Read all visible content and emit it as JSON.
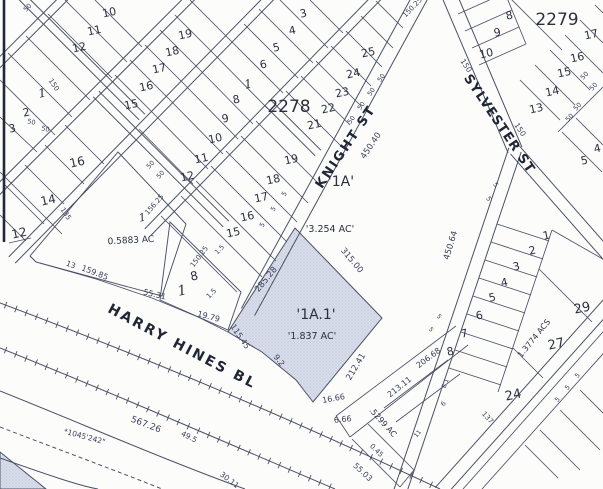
{
  "map": {
    "background": "#fcfcfb",
    "colors": {
      "ink": "#4b5166",
      "text": "#2a3040",
      "dim_text": "#3a415a",
      "street_text": "#1f2636",
      "hatch_fill": "#e3e6f0",
      "hatch_line": "#a9b2cc"
    },
    "block_numbers": [
      {
        "t": "2278",
        "x": 289,
        "y": 112,
        "s": 17
      },
      {
        "t": "2279",
        "x": 557,
        "y": 25,
        "s": 17
      }
    ],
    "street_names": [
      {
        "t": "KNIGHT  ST",
        "x": 349,
        "y": 149,
        "r": -56,
        "s": 13,
        "sp": 2
      },
      {
        "t": "SYLVESTER  ST",
        "x": 496,
        "y": 126,
        "r": 56,
        "s": 13,
        "sp": 1
      },
      {
        "t": "HARRY  HINES  BLVD",
        "curve": true,
        "s": 14,
        "sp": 2.5
      }
    ],
    "parcel_labels": [
      {
        "t": "'1A'",
        "x": 341,
        "y": 186,
        "s": 14
      },
      {
        "t": "'3.254 AC'",
        "x": 330,
        "y": 232,
        "s": 9.5
      },
      {
        "t": "'1A.1'",
        "x": 316,
        "y": 319,
        "s": 14
      },
      {
        "t": "'1.837 AC'",
        "x": 312,
        "y": 339,
        "s": 9.5
      },
      {
        "t": "0.5883 AC",
        "x": 131,
        "y": 243,
        "s": 9,
        "r": -3
      },
      {
        "t": ".5299 AC",
        "x": 381,
        "y": 424,
        "s": 8,
        "r": 48
      },
      {
        "t": "1.3774 ACS",
        "x": 536,
        "y": 340,
        "s": 8,
        "r": -51
      }
    ],
    "lot_numbers": [
      {
        "t": "10",
        "x": 110,
        "y": 16
      },
      {
        "t": "11",
        "x": 95,
        "y": 34
      },
      {
        "t": "12",
        "x": 80,
        "y": 51
      },
      {
        "t": "1",
        "x": 43,
        "y": 97,
        "serif": true,
        "s": 12
      },
      {
        "t": "2",
        "x": 27,
        "y": 116
      },
      {
        "t": "3",
        "x": 13,
        "y": 132
      },
      {
        "t": "16",
        "x": 78,
        "y": 166,
        "s": 12
      },
      {
        "t": "14",
        "x": 49,
        "y": 204,
        "s": 12
      },
      {
        "t": "12",
        "x": 20,
        "y": 237,
        "s": 12
      },
      {
        "t": "19",
        "x": 186,
        "y": 38
      },
      {
        "t": "18",
        "x": 173,
        "y": 55
      },
      {
        "t": "17",
        "x": 160,
        "y": 72
      },
      {
        "t": "16",
        "x": 147,
        "y": 90
      },
      {
        "t": "15",
        "x": 132,
        "y": 108
      },
      {
        "t": "8",
        "x": 237,
        "y": 103
      },
      {
        "t": "9",
        "x": 226,
        "y": 122
      },
      {
        "t": "10",
        "x": 216,
        "y": 142
      },
      {
        "t": "11",
        "x": 202,
        "y": 162
      },
      {
        "t": "12",
        "x": 188,
        "y": 180
      },
      {
        "t": "19",
        "x": 292,
        "y": 163
      },
      {
        "t": "18",
        "x": 274,
        "y": 183
      },
      {
        "t": "17",
        "x": 262,
        "y": 201
      },
      {
        "t": "16",
        "x": 248,
        "y": 220
      },
      {
        "t": "15",
        "x": 234,
        "y": 236
      },
      {
        "t": "25",
        "x": 369,
        "y": 56
      },
      {
        "t": "24",
        "x": 354,
        "y": 77
      },
      {
        "t": "23",
        "x": 343,
        "y": 96
      },
      {
        "t": "22",
        "x": 329,
        "y": 112
      },
      {
        "t": "21",
        "x": 315,
        "y": 128
      },
      {
        "t": "3",
        "x": 304,
        "y": 17
      },
      {
        "t": "4",
        "x": 293,
        "y": 34
      },
      {
        "t": "5",
        "x": 277,
        "y": 51
      },
      {
        "t": "6",
        "x": 264,
        "y": 68
      },
      {
        "t": "1",
        "x": 249,
        "y": 88,
        "serif": true,
        "s": 12
      },
      {
        "t": "8",
        "x": 510,
        "y": 19
      },
      {
        "t": "9",
        "x": 498,
        "y": 36
      },
      {
        "t": "10",
        "x": 487,
        "y": 57
      },
      {
        "t": "13",
        "x": 537,
        "y": 112
      },
      {
        "t": "14",
        "x": 553,
        "y": 95
      },
      {
        "t": "15",
        "x": 565,
        "y": 76
      },
      {
        "t": "16",
        "x": 578,
        "y": 61
      },
      {
        "t": "17",
        "x": 592,
        "y": 38
      },
      {
        "t": "5",
        "x": 585,
        "y": 164
      },
      {
        "t": "4",
        "x": 598,
        "y": 152
      },
      {
        "t": "1",
        "x": 547,
        "y": 239
      },
      {
        "t": "2",
        "x": 533,
        "y": 254
      },
      {
        "t": "3",
        "x": 517,
        "y": 270
      },
      {
        "t": "4",
        "x": 505,
        "y": 286
      },
      {
        "t": "5",
        "x": 493,
        "y": 301
      },
      {
        "t": "6",
        "x": 480,
        "y": 319
      },
      {
        "t": "7",
        "x": 465,
        "y": 337
      },
      {
        "t": "8",
        "x": 451,
        "y": 355
      },
      {
        "t": "24",
        "x": 514,
        "y": 399,
        "s": 13
      },
      {
        "t": "27",
        "x": 557,
        "y": 348,
        "s": 13
      },
      {
        "t": "29",
        "x": 583,
        "y": 312,
        "s": 13
      },
      {
        "t": "1",
        "x": 183,
        "y": 295,
        "s": 14,
        "serif": true
      },
      {
        "t": "8",
        "x": 195,
        "y": 280,
        "s": 12
      },
      {
        "t": "1",
        "x": 143,
        "y": 221,
        "s": 11,
        "serif": true
      }
    ],
    "dimensions": [
      {
        "t": "450.40",
        "x": 373,
        "y": 147,
        "r": -56,
        "s": 8.5
      },
      {
        "t": "450.64",
        "x": 453,
        "y": 246,
        "r": -73,
        "s": 8.5
      },
      {
        "t": "315.00",
        "x": 350,
        "y": 262,
        "r": 50,
        "s": 8.5
      },
      {
        "t": "285.28",
        "x": 268,
        "y": 281,
        "r": -51,
        "s": 8.5
      },
      {
        "t": "212.41",
        "x": 358,
        "y": 368,
        "r": -59,
        "s": 8.5
      },
      {
        "t": "206.68",
        "x": 430,
        "y": 360,
        "r": -37,
        "s": 8
      },
      {
        "t": "213.11",
        "x": 401,
        "y": 389,
        "r": -38,
        "s": 8
      },
      {
        "t": "115.45",
        "x": 238,
        "y": 338,
        "r": 56,
        "s": 8
      },
      {
        "t": "9.2",
        "x": 277,
        "y": 362,
        "r": 52,
        "s": 8
      },
      {
        "t": "16.66",
        "x": 334,
        "y": 401,
        "r": -10,
        "s": 8
      },
      {
        "t": "6.66",
        "x": 343,
        "y": 422,
        "r": -6,
        "s": 8
      },
      {
        "t": "0.45",
        "x": 375,
        "y": 452,
        "r": 45,
        "s": 7
      },
      {
        "t": "55.03",
        "x": 361,
        "y": 474,
        "r": 43,
        "s": 8
      },
      {
        "t": "567.26",
        "x": 145,
        "y": 427,
        "r": 21,
        "s": 9
      },
      {
        "t": "49.5",
        "x": 188,
        "y": 439,
        "r": 27,
        "s": 7.5
      },
      {
        "t": "30.11",
        "x": 228,
        "y": 482,
        "r": 37,
        "s": 7.5
      },
      {
        "t": "*1045'242\"",
        "x": 84,
        "y": 439,
        "r": 15,
        "s": 7.5
      },
      {
        "t": "159.85",
        "x": 94,
        "y": 275,
        "r": 21,
        "s": 8
      },
      {
        "t": "13",
        "x": 70,
        "y": 267,
        "r": 21,
        "s": 7.5
      },
      {
        "t": "55.31",
        "x": 154,
        "y": 297,
        "r": 13,
        "s": 8
      },
      {
        "t": "19.79",
        "x": 208,
        "y": 319,
        "r": 15,
        "s": 8
      },
      {
        "t": "150.25",
        "x": 201,
        "y": 258,
        "r": -53,
        "s": 7
      },
      {
        "t": "156.25",
        "x": 156,
        "y": 206,
        "r": -49,
        "s": 7
      },
      {
        "t": "135",
        "x": 64,
        "y": 215,
        "r": 56,
        "s": 7
      },
      {
        "t": "150",
        "x": 52,
        "y": 86,
        "r": 56,
        "s": 7
      },
      {
        "t": "50",
        "x": 31,
        "y": 124,
        "r": 12,
        "s": 6.5
      },
      {
        "t": "50",
        "x": 45,
        "y": 131,
        "r": 12,
        "s": 6.5
      },
      {
        "t": "50",
        "x": 152,
        "y": 166,
        "r": -46,
        "s": 6.5
      },
      {
        "t": "50",
        "x": 162,
        "y": 176,
        "r": -46,
        "s": 6.5
      },
      {
        "t": "50",
        "x": 29,
        "y": 9,
        "r": -46,
        "s": 6.5
      },
      {
        "t": "150",
        "x": 464,
        "y": 67,
        "r": 56,
        "s": 7.5
      },
      {
        "t": "150",
        "x": 518,
        "y": 131,
        "r": 56,
        "s": 7.5
      },
      {
        "t": "50",
        "x": 586,
        "y": 77,
        "r": -46,
        "s": 6.5
      },
      {
        "t": "50",
        "x": 595,
        "y": 88,
        "r": -46,
        "s": 6.5
      },
      {
        "t": "50",
        "x": 571,
        "y": 119,
        "r": -46,
        "s": 6.5
      },
      {
        "t": "50",
        "x": 579,
        "y": 108,
        "r": -46,
        "s": 6.5
      },
      {
        "t": "50",
        "x": 353,
        "y": 121,
        "r": -56,
        "s": 6.5
      },
      {
        "t": "50",
        "x": 363,
        "y": 107,
        "r": -56,
        "s": 6.5
      },
      {
        "t": "50",
        "x": 373,
        "y": 93,
        "r": -56,
        "s": 6.5
      },
      {
        "t": "50",
        "x": 383,
        "y": 79,
        "r": -56,
        "s": 6.5
      },
      {
        "t": "5",
        "x": 286,
        "y": 195,
        "r": -56,
        "s": 6.5
      },
      {
        "t": "5",
        "x": 275,
        "y": 210,
        "r": -56,
        "s": 6.5
      },
      {
        "t": "5",
        "x": 264,
        "y": 226,
        "r": -56,
        "s": 6.5
      },
      {
        "t": "1.5",
        "x": 213,
        "y": 295,
        "r": -46,
        "s": 7
      },
      {
        "t": "1.5",
        "x": 221,
        "y": 251,
        "r": -46,
        "s": 6.5
      },
      {
        "t": "137",
        "x": 486,
        "y": 419,
        "r": 48,
        "s": 7
      },
      {
        "t": "11",
        "x": 419,
        "y": 435,
        "r": -50,
        "s": 6
      },
      {
        "t": "6",
        "x": 445,
        "y": 405,
        "r": -50,
        "s": 6.5
      },
      {
        "t": "E 1",
        "x": 447,
        "y": 384,
        "r": -70,
        "s": 6
      },
      {
        "t": "5",
        "x": 559,
        "y": 401,
        "r": -46,
        "s": 6.5
      },
      {
        "t": "5",
        "x": 569,
        "y": 389,
        "r": -46,
        "s": 6.5
      },
      {
        "t": "5",
        "x": 579,
        "y": 377,
        "r": -46,
        "s": 6.5
      },
      {
        "t": "5",
        "x": 430,
        "y": 331,
        "r": 40,
        "s": 6
      },
      {
        "t": "5",
        "x": 438,
        "y": 318,
        "r": 40,
        "s": 6
      },
      {
        "t": "150.25",
        "x": 414,
        "y": 9,
        "r": -46,
        "s": 7
      },
      {
        "t": "5",
        "x": 494,
        "y": 186,
        "r": 56,
        "s": 6.5
      },
      {
        "t": "5",
        "x": 487,
        "y": 200,
        "r": 56,
        "s": 6.5
      }
    ]
  }
}
